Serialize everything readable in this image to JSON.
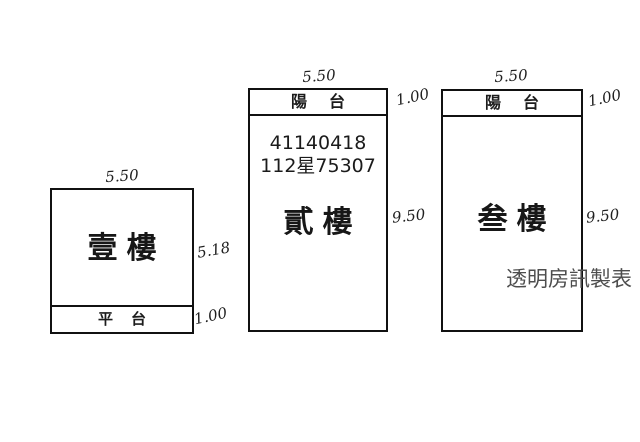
{
  "plan": {
    "watermark": "透明房訊製表",
    "buildings": [
      {
        "id": "first-floor",
        "room_label": "壹樓",
        "width_dim": "5.50",
        "height_dim": "5.18",
        "strip": {
          "label": "平台",
          "position": "bottom",
          "height_dim": "1.00"
        }
      },
      {
        "id": "second-floor",
        "room_label": "貳樓",
        "width_dim": "5.50",
        "height_dim": "9.50",
        "strip": {
          "label": "陽台",
          "position": "top",
          "height_dim": "1.00"
        },
        "registration_numbers": [
          "41140418",
          "112星75307"
        ]
      },
      {
        "id": "third-floor",
        "room_label": "叁樓",
        "width_dim": "5.50",
        "height_dim": "9.50",
        "strip": {
          "label": "陽台",
          "position": "top",
          "height_dim": "1.00"
        }
      }
    ],
    "colors": {
      "line": "#111111",
      "ink": "#1c1c1c",
      "watermark": "#4d4d4d",
      "background": "#ffffff"
    }
  }
}
